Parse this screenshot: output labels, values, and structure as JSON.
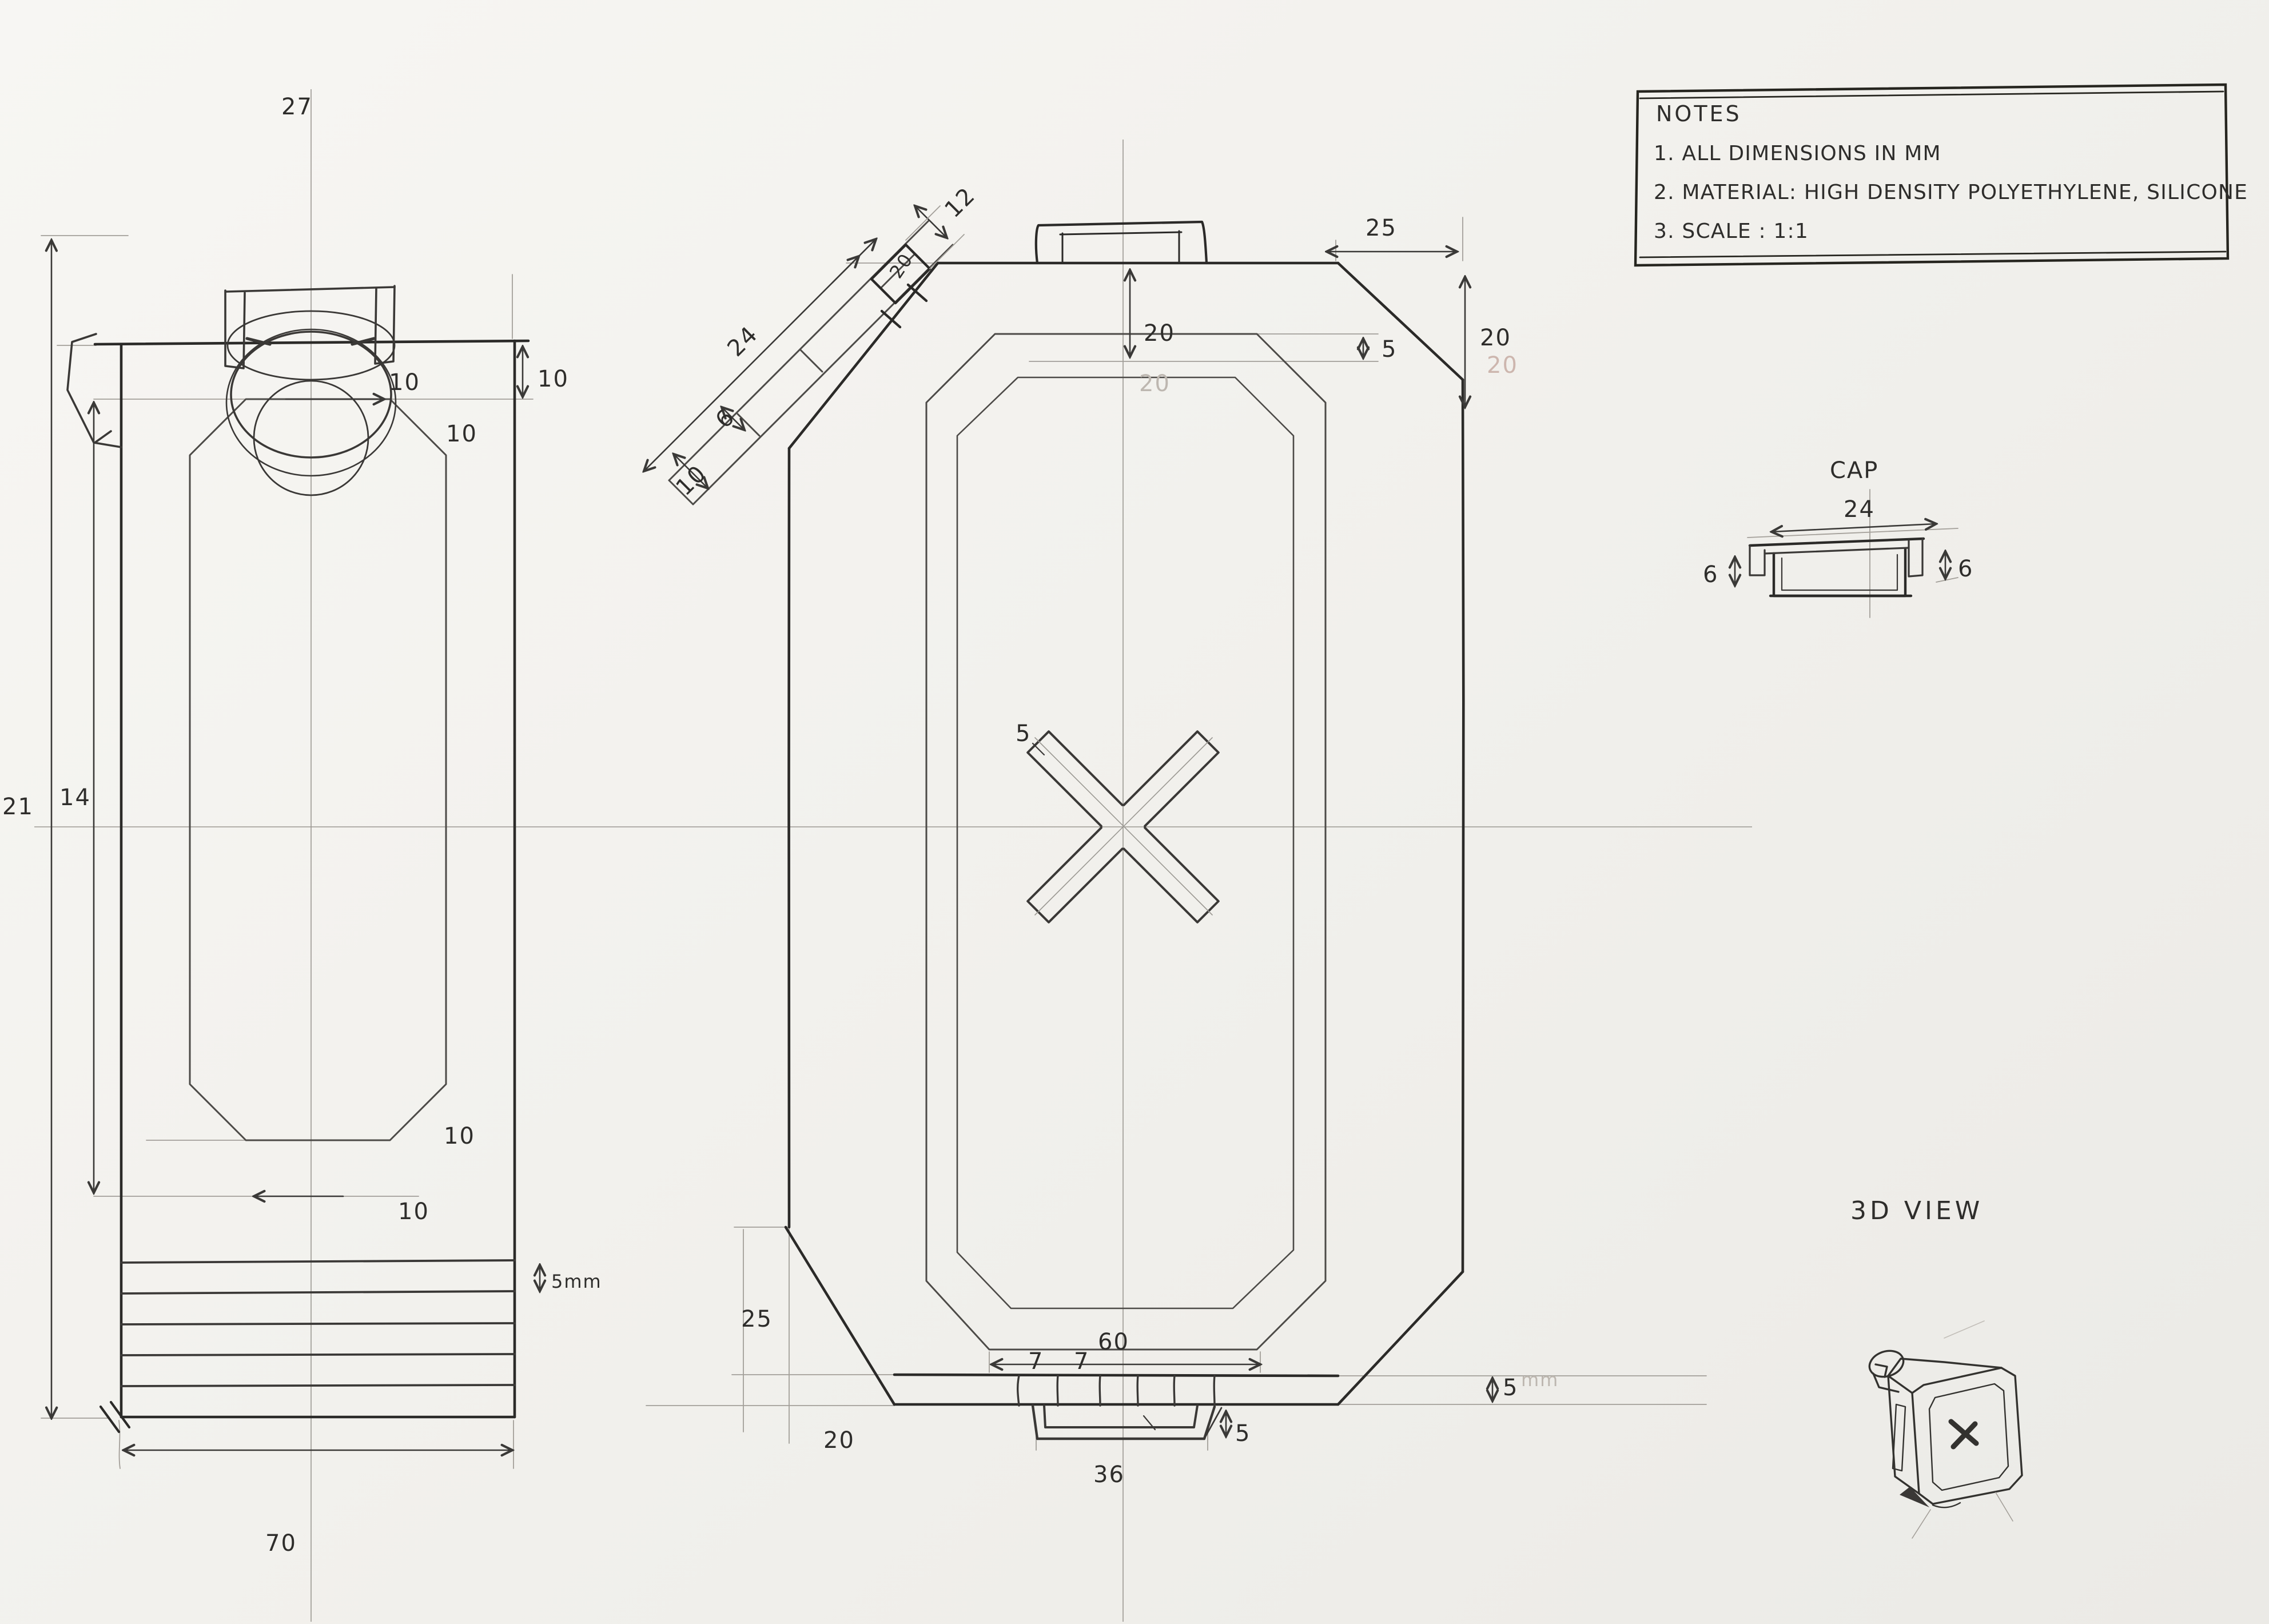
{
  "notes": {
    "title": "NOTES",
    "items": [
      "1. ALL DIMENSIONS IN MM",
      "2. MATERIAL: HIGH DENSITY POLYETHYLENE, SILICONE",
      "3. SCALE : 1:1"
    ]
  },
  "side_view": {
    "dims": {
      "cap_width": "27",
      "top_gap": "10",
      "chamfer_top_h": "10",
      "chamfer_top_v": "10",
      "overall_height": "21",
      "panel_height": "14",
      "chamfer_bottom_v": "10",
      "chamfer_bottom_h": "10",
      "rib_spacing": "5mm",
      "base_width": "70"
    }
  },
  "front_view": {
    "dims": {
      "spout_length": "24",
      "spout_width": "6",
      "spout_tip": "10",
      "spout_mouth": "12",
      "spout_depth": "20",
      "top_inset": "20",
      "top_inset_faint": "20",
      "tr_chamfer_w": "25",
      "tr_chamfer_h": "20",
      "tr_chamfer_h_faint": "20",
      "top_wall": "5",
      "x_arm_width": "5",
      "panel_bottom_width": "60",
      "boss_seg_a": "7",
      "boss_seg_b": "7",
      "bl_chamfer_v": "25",
      "bl_chamfer_h": "20",
      "boss_width": "36",
      "boss_height": "5",
      "base_step": "5",
      "base_step_unit": "mm"
    }
  },
  "cap_detail": {
    "title": "CAP",
    "dims": {
      "width": "24",
      "height_left": "6",
      "height_right": "6"
    }
  },
  "iso_view": {
    "title": "3D VIEW"
  }
}
